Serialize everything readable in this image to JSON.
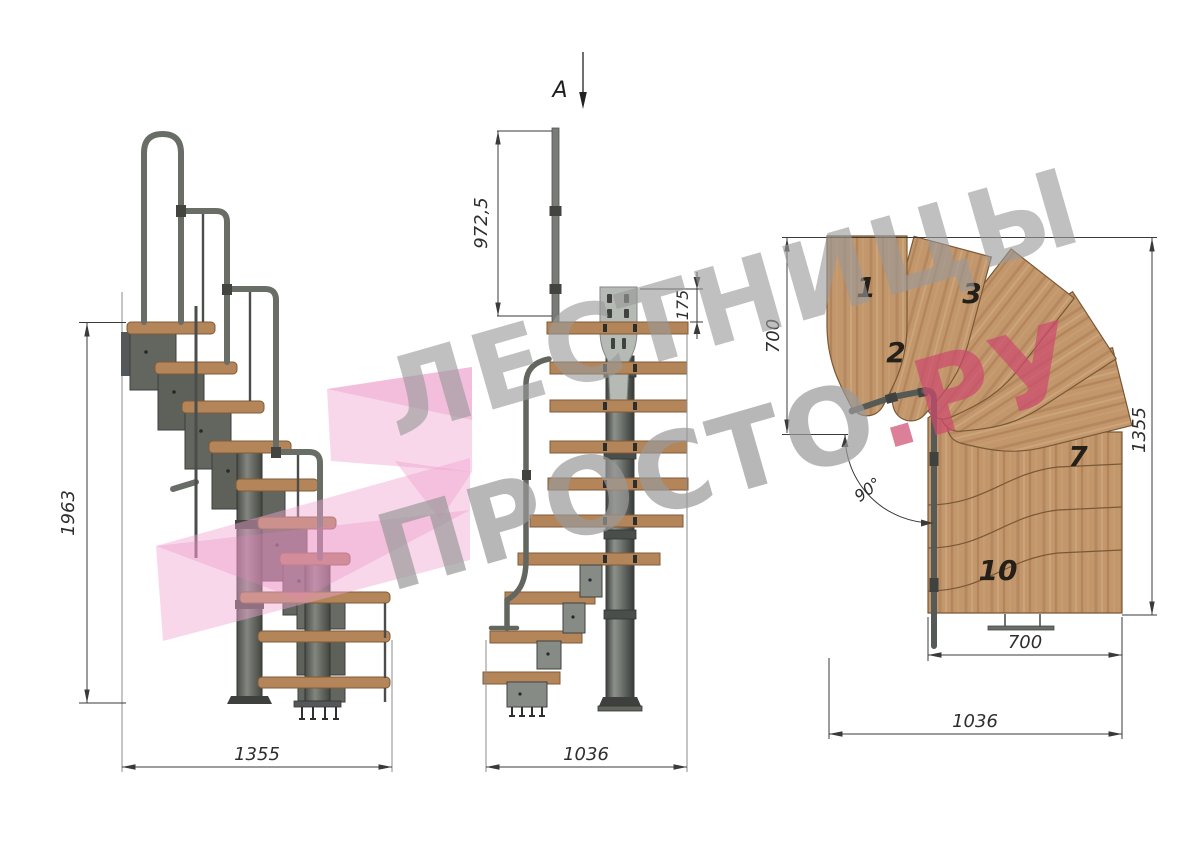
{
  "watermark": {
    "line1": "ЛЕСТНИЦЫ",
    "line2": "ПРОСТО",
    "line2_accent": ".РУ",
    "text_color": "#9a9a9a",
    "accent_color": "#ce4a6e",
    "logo_pink": "#f2a7d3"
  },
  "section_marker": {
    "label": "A"
  },
  "side_view": {
    "total_height": "1963",
    "total_run": "1355"
  },
  "front_view": {
    "handrail_post_height": "972,5",
    "bracket_plate_height": "175",
    "total_width": "1036"
  },
  "plan_view": {
    "upper_flight_width": "700",
    "overall_depth": "1355",
    "lower_flight_width": "700",
    "overall_width": "1036",
    "turn_angle": "90°",
    "treads": [
      {
        "label": "1"
      },
      {
        "label": "2"
      },
      {
        "label": "3"
      },
      {
        "label": "7"
      },
      {
        "label": "10"
      }
    ]
  },
  "colors": {
    "wood": "#c2976c",
    "wood_edge": "#7a5835",
    "metal": "#62665f",
    "metal_dark": "#3c3f3c",
    "plate_gray": "#b6bab4",
    "dim_line": "#3a3a3a"
  }
}
